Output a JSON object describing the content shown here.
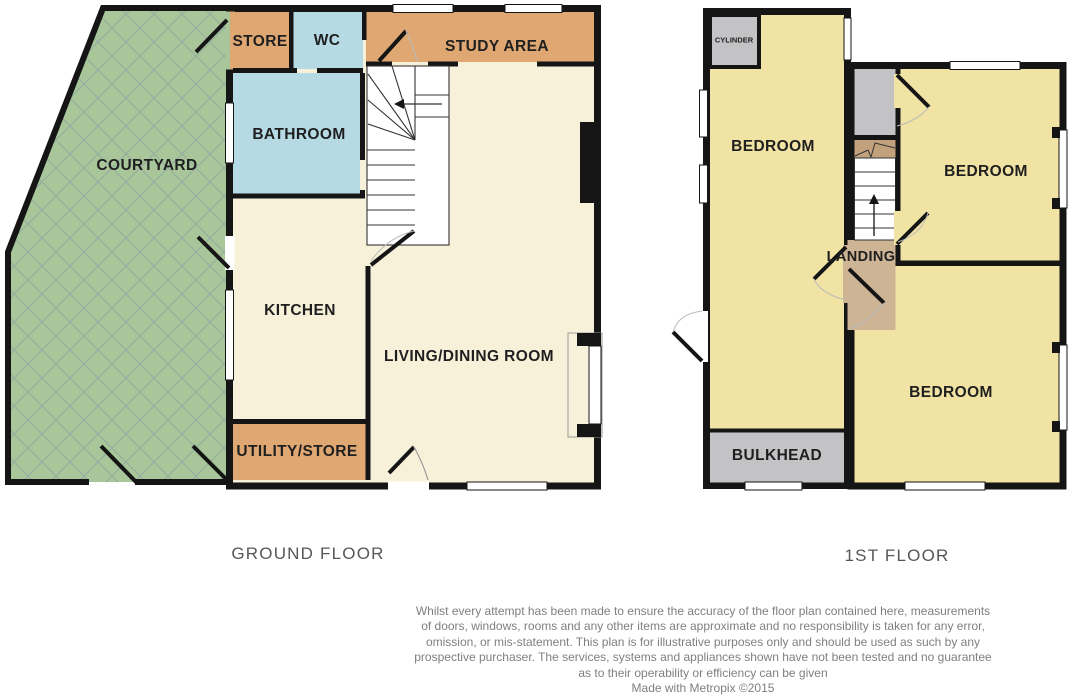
{
  "plan": {
    "ground_floor": {
      "title": "GROUND FLOOR",
      "rooms": {
        "courtyard": "COURTYARD",
        "store": "STORE",
        "wc": "WC",
        "study_area": "STUDY AREA",
        "bathroom": "BATHROOM",
        "kitchen": "KITCHEN",
        "living_dining": "LIVING/DINING ROOM",
        "utility_store": "UTILITY/STORE"
      }
    },
    "first_floor": {
      "title": "1ST FLOOR",
      "rooms": {
        "cylinder": "CYLINDER",
        "bedroom_left": "BEDROOM",
        "bedroom_top_right": "BEDROOM",
        "bedroom_bottom_right": "BEDROOM",
        "landing": "LANDING",
        "bulkhead": "BULKHEAD"
      }
    }
  },
  "colors": {
    "courtyard_green": "#a8c69a",
    "hatch_line": "#7d93a8",
    "tan": "#dfa873",
    "blue": "#b6dae4",
    "cream": "#f8f1da",
    "yellow": "#f1e3a3",
    "gray": "#c3c3c5",
    "stair_strip_tan": "#c2a27c",
    "landing_tan": "#cdb494",
    "wall": "#151515"
  },
  "footer": {
    "disclaimer_lines": [
      "Whilst every attempt has been made to ensure the accuracy of the floor plan contained here, measurements",
      "of doors, windows, rooms and any other items are approximate and no responsibility is taken for any error,",
      "omission, or mis-statement. This plan is for illustrative purposes only and should be used as such by any",
      "prospective purchaser. The services, systems and appliances shown have not been tested and no guarantee",
      "as to their operability or efficiency can be given"
    ],
    "credit": "Made with Metropix ©2015"
  }
}
